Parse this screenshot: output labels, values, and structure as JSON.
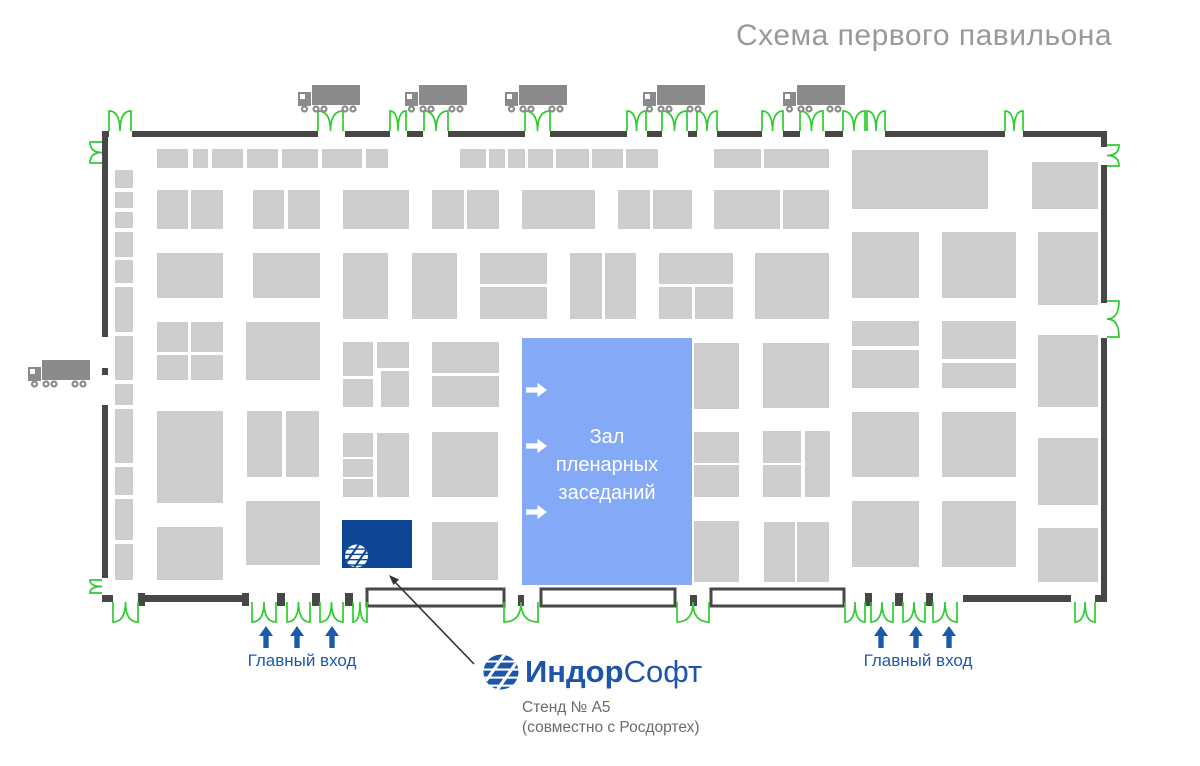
{
  "title": "Схема первого павильона",
  "hall": {
    "lines": [
      "Зал",
      "пленарных",
      "заседаний"
    ],
    "rect": [
      522,
      338,
      170,
      247
    ],
    "arrow_x": 526,
    "arrow_ys": [
      390,
      446,
      512
    ]
  },
  "entrances": {
    "left_label": "Главный вход",
    "right_label": "Главный вход",
    "left_arrow_x": [
      266,
      297,
      332
    ],
    "right_arrow_x": [
      881,
      916,
      949
    ],
    "arrow_tip_y": 626,
    "arrow_base_y": 648
  },
  "legend": {
    "logo_bold": "Индор",
    "logo_regular": "Софт",
    "stand_number": "Стенд № А5",
    "stand_partner": "(совместно с Росдортех)"
  },
  "colors": {
    "wall": "#474747",
    "booth": "#cdcdcd",
    "truck": "#8a8a8a",
    "door": "#2ecc2e",
    "hall_fill": "#84a9f6",
    "hall_text": "#ffffff",
    "indor_booth": "#0c4695",
    "blue_text": "#1d5aab",
    "title_gray": "#999999",
    "caption_gray": "#6b6b6b",
    "callout": "#333333"
  },
  "floorplan": {
    "indor_booth_rect": [
      342,
      520,
      70,
      48
    ],
    "callout": {
      "x1": 474,
      "y1": 664,
      "x2": 394,
      "y2": 581
    },
    "trucks_top": [
      [
        298,
        85
      ],
      [
        405,
        85
      ],
      [
        505,
        85
      ],
      [
        643,
        85
      ],
      [
        783,
        85
      ]
    ],
    "trucks_side": [
      [
        28,
        360
      ]
    ],
    "vestibules": [
      [
        367,
        589,
        137,
        17
      ],
      [
        541,
        589,
        134,
        17
      ],
      [
        711,
        589,
        133,
        17
      ]
    ],
    "walls": [
      [
        102,
        131,
        7,
        6
      ],
      [
        132,
        131,
        186,
        6
      ],
      [
        345,
        131,
        45,
        6
      ],
      [
        407,
        131,
        16,
        6
      ],
      [
        448,
        131,
        77,
        6
      ],
      [
        550,
        131,
        77,
        6
      ],
      [
        647,
        131,
        15,
        6
      ],
      [
        688,
        131,
        9,
        6
      ],
      [
        717,
        131,
        45,
        6
      ],
      [
        783,
        131,
        17,
        6
      ],
      [
        825,
        131,
        18,
        6
      ],
      [
        885,
        131,
        120,
        6
      ],
      [
        1023,
        131,
        84,
        6
      ],
      [
        1101,
        137,
        6,
        10
      ],
      [
        102,
        137,
        6,
        200
      ],
      [
        102,
        368,
        6,
        7
      ],
      [
        102,
        405,
        6,
        173
      ],
      [
        1101,
        165,
        6,
        138
      ],
      [
        1101,
        338,
        6,
        264
      ],
      [
        102,
        595,
        11,
        7
      ],
      [
        145,
        595,
        98,
        7
      ],
      [
        963,
        595,
        108,
        7
      ],
      [
        1095,
        595,
        12,
        7
      ],
      [
        138,
        593,
        7,
        13
      ],
      [
        242,
        593,
        7,
        13
      ],
      [
        277,
        593,
        8,
        13
      ],
      [
        312,
        593,
        8,
        13
      ],
      [
        345,
        593,
        8,
        13
      ],
      [
        518,
        595,
        6,
        11
      ],
      [
        690,
        595,
        7,
        11
      ],
      [
        865,
        593,
        7,
        13
      ],
      [
        895,
        593,
        8,
        13
      ],
      [
        926,
        593,
        7,
        13
      ]
    ],
    "doors": [
      {
        "s": "t",
        "a": 109,
        "b": 131,
        "y": 131
      },
      {
        "s": "t",
        "a": 318,
        "b": 343,
        "y": 131
      },
      {
        "s": "t",
        "a": 390,
        "b": 406,
        "y": 131
      },
      {
        "s": "t",
        "a": 424,
        "b": 448,
        "y": 131
      },
      {
        "s": "t",
        "a": 525,
        "b": 550,
        "y": 131
      },
      {
        "s": "t",
        "a": 627,
        "b": 646,
        "y": 131
      },
      {
        "s": "t",
        "a": 662,
        "b": 687,
        "y": 131
      },
      {
        "s": "t",
        "a": 697,
        "b": 717,
        "y": 131
      },
      {
        "s": "t",
        "a": 762,
        "b": 783,
        "y": 131
      },
      {
        "s": "t",
        "a": 800,
        "b": 823,
        "y": 131
      },
      {
        "s": "t",
        "a": 843,
        "b": 865,
        "y": 131
      },
      {
        "s": "t",
        "a": 867,
        "b": 885,
        "y": 131
      },
      {
        "s": "t",
        "a": 1005,
        "b": 1023,
        "y": 131
      },
      {
        "s": "b",
        "a": 113,
        "b": 138,
        "y": 602
      },
      {
        "s": "b",
        "a": 252,
        "b": 276,
        "y": 602
      },
      {
        "s": "b",
        "a": 287,
        "b": 310,
        "y": 602
      },
      {
        "s": "b",
        "a": 320,
        "b": 343,
        "y": 602
      },
      {
        "s": "b",
        "a": 353,
        "b": 367,
        "y": 602
      },
      {
        "s": "b",
        "a": 504,
        "b": 538,
        "y": 602
      },
      {
        "s": "b",
        "a": 677,
        "b": 709,
        "y": 602
      },
      {
        "s": "b",
        "a": 845,
        "b": 865,
        "y": 602
      },
      {
        "s": "b",
        "a": 871,
        "b": 893,
        "y": 602
      },
      {
        "s": "b",
        "a": 903,
        "b": 925,
        "y": 602
      },
      {
        "s": "b",
        "a": 933,
        "b": 957,
        "y": 602
      },
      {
        "s": "b",
        "a": 1075,
        "b": 1095,
        "y": 602
      },
      {
        "s": "l",
        "a": 142,
        "b": 163,
        "x": 102
      },
      {
        "s": "l",
        "a": 580,
        "b": 593,
        "x": 102
      },
      {
        "s": "r",
        "a": 145,
        "b": 166,
        "x": 1107
      },
      {
        "s": "r",
        "a": 301,
        "b": 337,
        "x": 1107
      }
    ],
    "booths": [
      [
        157,
        149,
        31,
        19
      ],
      [
        193,
        149,
        15,
        19
      ],
      [
        212,
        149,
        31,
        19
      ],
      [
        247,
        149,
        31,
        19
      ],
      [
        282,
        149,
        36,
        19
      ],
      [
        322,
        149,
        40,
        19
      ],
      [
        366,
        149,
        22,
        19
      ],
      [
        460,
        149,
        26,
        19
      ],
      [
        489,
        149,
        16,
        19
      ],
      [
        508,
        149,
        17,
        19
      ],
      [
        528,
        149,
        25,
        19
      ],
      [
        556,
        149,
        33,
        19
      ],
      [
        592,
        149,
        31,
        19
      ],
      [
        626,
        149,
        32,
        19
      ],
      [
        714,
        149,
        47,
        19
      ],
      [
        764,
        149,
        65,
        19
      ],
      [
        852,
        150,
        136,
        59
      ],
      [
        1032,
        162,
        66,
        47
      ],
      [
        115,
        170,
        18,
        18
      ],
      [
        115,
        192,
        18,
        16
      ],
      [
        115,
        212,
        18,
        16
      ],
      [
        115,
        232,
        18,
        25
      ],
      [
        115,
        260,
        18,
        23
      ],
      [
        115,
        287,
        18,
        45
      ],
      [
        115,
        336,
        18,
        44
      ],
      [
        115,
        384,
        18,
        21
      ],
      [
        115,
        409,
        18,
        54
      ],
      [
        115,
        467,
        18,
        28
      ],
      [
        115,
        499,
        18,
        41
      ],
      [
        115,
        544,
        18,
        36
      ],
      [
        157,
        190,
        31,
        39
      ],
      [
        191,
        190,
        32,
        39
      ],
      [
        253,
        190,
        31,
        39
      ],
      [
        288,
        190,
        32,
        39
      ],
      [
        343,
        190,
        66,
        39
      ],
      [
        432,
        190,
        32,
        39
      ],
      [
        467,
        190,
        32,
        39
      ],
      [
        522,
        190,
        73,
        39
      ],
      [
        618,
        190,
        32,
        39
      ],
      [
        653,
        190,
        39,
        39
      ],
      [
        714,
        190,
        66,
        39
      ],
      [
        783,
        190,
        46,
        39
      ],
      [
        852,
        232,
        67,
        66
      ],
      [
        942,
        232,
        74,
        66
      ],
      [
        1038,
        232,
        60,
        73
      ],
      [
        157,
        253,
        66,
        45
      ],
      [
        253,
        253,
        67,
        45
      ],
      [
        343,
        253,
        45,
        66
      ],
      [
        412,
        253,
        45,
        66
      ],
      [
        480,
        253,
        67,
        31
      ],
      [
        480,
        287,
        67,
        32
      ],
      [
        570,
        253,
        32,
        66
      ],
      [
        605,
        253,
        31,
        66
      ],
      [
        659,
        253,
        74,
        31
      ],
      [
        659,
        287,
        33,
        32
      ],
      [
        695,
        287,
        38,
        32
      ],
      [
        755,
        253,
        74,
        66
      ],
      [
        157,
        322,
        31,
        30
      ],
      [
        191,
        322,
        32,
        30
      ],
      [
        157,
        355,
        31,
        25
      ],
      [
        191,
        355,
        32,
        25
      ],
      [
        246,
        322,
        74,
        58
      ],
      [
        343,
        342,
        30,
        34
      ],
      [
        343,
        379,
        30,
        28
      ],
      [
        377,
        342,
        32,
        26
      ],
      [
        381,
        371,
        28,
        36
      ],
      [
        432,
        342,
        67,
        31
      ],
      [
        432,
        376,
        67,
        31
      ],
      [
        694,
        343,
        45,
        66
      ],
      [
        763,
        343,
        66,
        65
      ],
      [
        852,
        321,
        67,
        25
      ],
      [
        852,
        350,
        67,
        38
      ],
      [
        942,
        321,
        74,
        38
      ],
      [
        942,
        363,
        74,
        25
      ],
      [
        1038,
        335,
        60,
        72
      ],
      [
        157,
        411,
        66,
        92
      ],
      [
        247,
        411,
        35,
        66
      ],
      [
        286,
        411,
        33,
        66
      ],
      [
        343,
        433,
        30,
        24
      ],
      [
        343,
        459,
        30,
        18
      ],
      [
        343,
        479,
        30,
        18
      ],
      [
        377,
        433,
        32,
        64
      ],
      [
        432,
        432,
        66,
        65
      ],
      [
        694,
        432,
        45,
        31
      ],
      [
        694,
        465,
        45,
        32
      ],
      [
        763,
        431,
        38,
        32
      ],
      [
        805,
        431,
        25,
        66
      ],
      [
        763,
        465,
        38,
        32
      ],
      [
        852,
        412,
        67,
        65
      ],
      [
        942,
        412,
        74,
        65
      ],
      [
        1038,
        438,
        60,
        67
      ],
      [
        157,
        527,
        66,
        53
      ],
      [
        246,
        501,
        74,
        64
      ],
      [
        432,
        522,
        66,
        58
      ],
      [
        694,
        521,
        45,
        61
      ],
      [
        764,
        522,
        31,
        60
      ],
      [
        797,
        522,
        32,
        60
      ],
      [
        852,
        501,
        67,
        66
      ],
      [
        942,
        501,
        74,
        66
      ],
      [
        1038,
        528,
        60,
        54
      ]
    ]
  }
}
